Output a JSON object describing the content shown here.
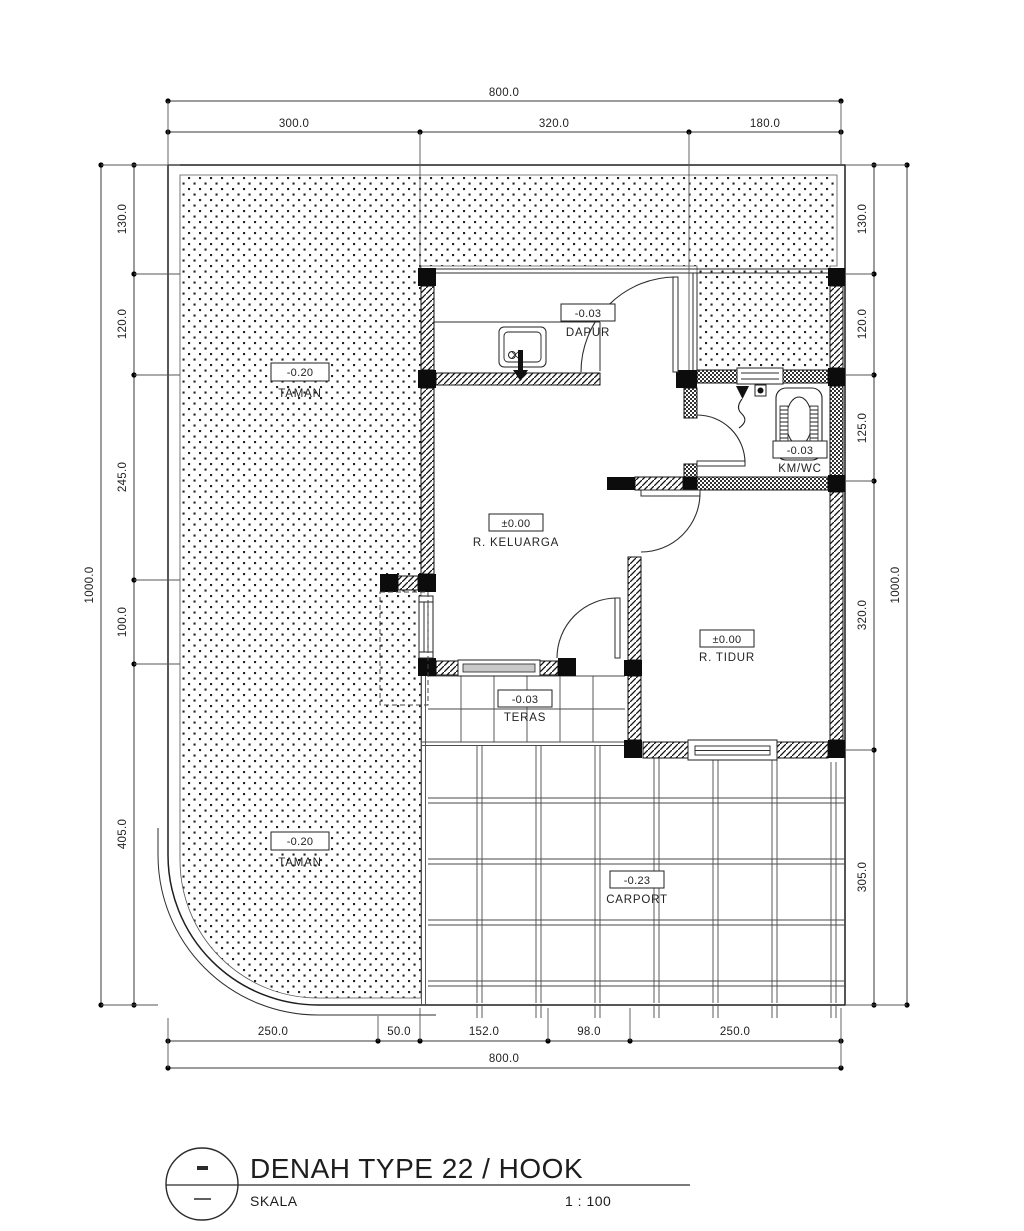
{
  "title_block": {
    "title": "DENAH TYPE 22 / HOOK",
    "scale_label": "SKALA",
    "scale_value": "1 : 100"
  },
  "rooms": {
    "dapur": {
      "name": "DAPUR",
      "level": "-0.03"
    },
    "taman_top": {
      "name": "TAMAN",
      "level": "-0.20"
    },
    "km_wc": {
      "name": "KM/WC",
      "level": "-0.03"
    },
    "r_keluarga": {
      "name": "R. KELUARGA",
      "level": "±0.00"
    },
    "r_tidur": {
      "name": "R. TIDUR",
      "level": "±0.00"
    },
    "teras": {
      "name": "TERAS",
      "level": "-0.03"
    },
    "taman_bottom": {
      "name": "TAMAN",
      "level": "-0.20"
    },
    "carport": {
      "name": "CARPORT",
      "level": "-0.23"
    }
  },
  "dimensions": {
    "top": {
      "total": "800.0",
      "segments": [
        "300.0",
        "320.0",
        "180.0"
      ]
    },
    "bottom": {
      "total": "800.0",
      "segments": [
        "250.0",
        "50.0",
        "152.0",
        "98.0",
        "250.0"
      ]
    },
    "left": {
      "total": "1000.0",
      "segments": [
        "130.0",
        "120.0",
        "245.0",
        "100.0",
        "405.0"
      ]
    },
    "right": {
      "total": "1000.0",
      "segments": [
        "130.0",
        "120.0",
        "125.0",
        "320.0",
        "305.0"
      ]
    }
  }
}
